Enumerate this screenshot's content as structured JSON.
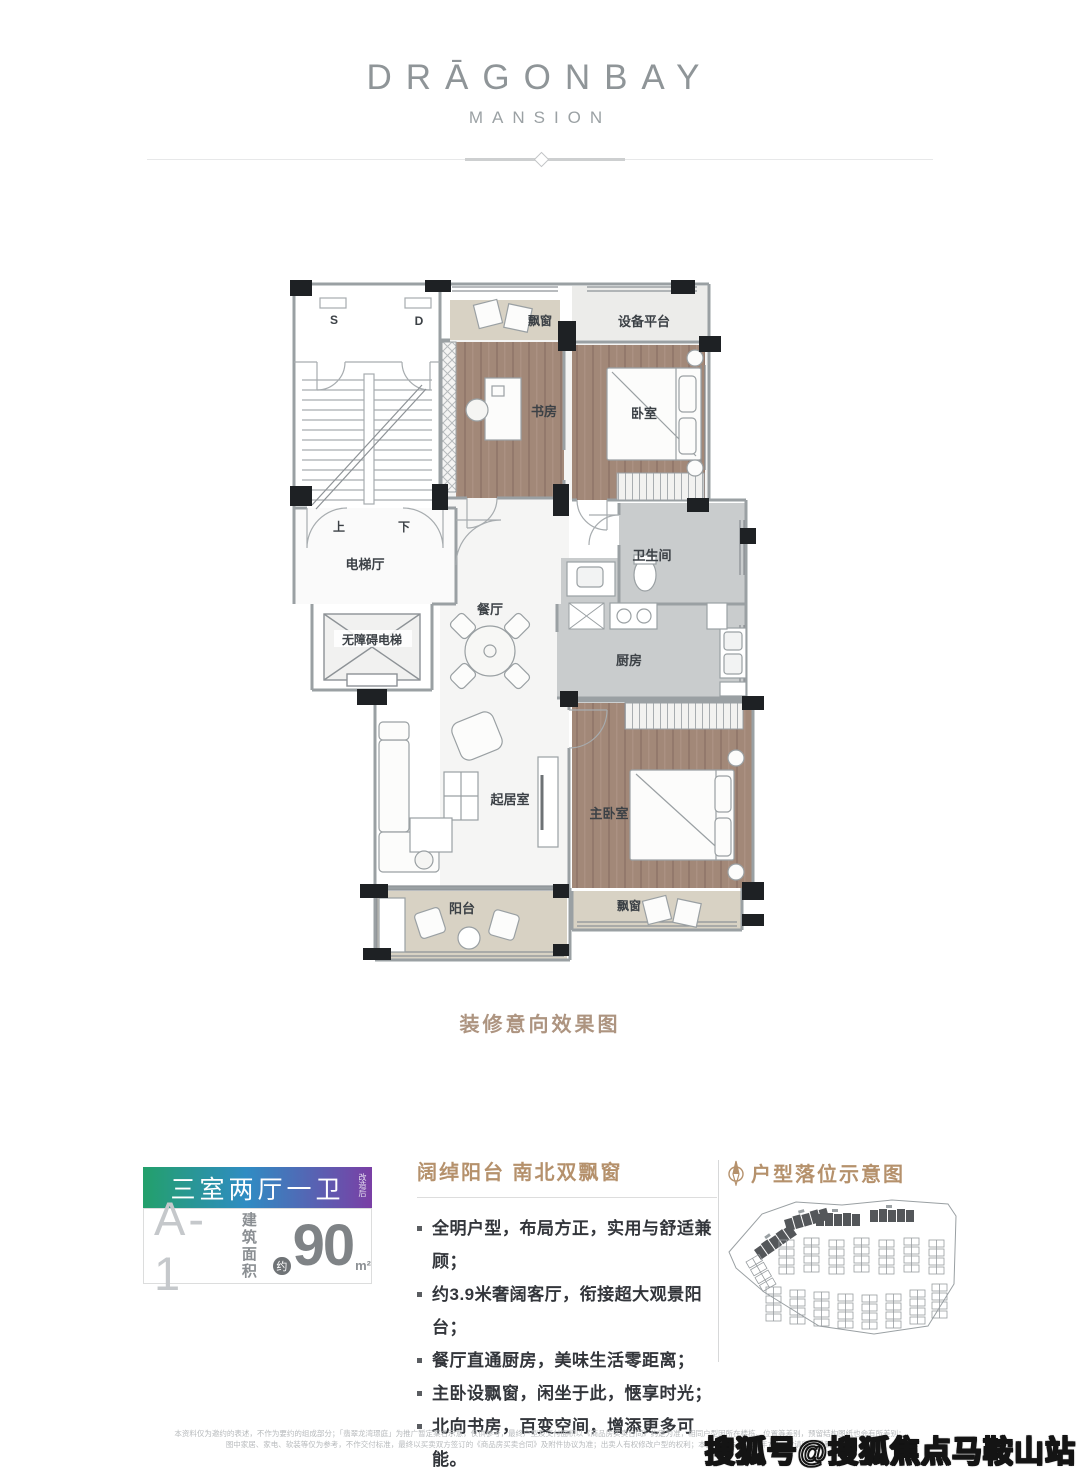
{
  "brand": {
    "name": "DRĀGONBAY",
    "subtitle": "MANSION"
  },
  "floorplan": {
    "caption": "装修意向效果图",
    "rooms": {
      "s": "S",
      "d": "D",
      "up": "上",
      "down": "下",
      "elevator_hall": "电梯厅",
      "accessible_elevator": "无障碍电梯",
      "dining": "餐厅",
      "bay_window_top": "飘窗",
      "equipment_platform": "设备平台",
      "study": "书房",
      "bedroom": "卧室",
      "bathroom": "卫生间",
      "kitchen": "厨房",
      "living": "起居室",
      "master_bedroom": "主卧室",
      "balcony": "阳台",
      "bay_window_bottom": "飘窗"
    }
  },
  "unit_card": {
    "layout": "三室两厅一卫",
    "layout_note": "改造后",
    "unit_no": "A-1",
    "area_prefix_1": "建筑",
    "area_prefix_2": "面积",
    "approx": "约",
    "area_value": "90",
    "area_unit": "m²",
    "gradient_left": "#23a06b",
    "gradient_mid": "#2f8cc3",
    "gradient_right": "#7a3fa5"
  },
  "features": {
    "heading": "阔绰阳台 南北双飘窗",
    "bullets": [
      "全明户型，布局方正，实用与舒适兼顾；",
      "约3.9米奢阔客厅，衔接超大观景阳台；",
      "餐厅直通厨房，美味生活零距离；",
      "主卧设飘窗，闲坐于此，惬享时光；",
      "北向书房，百变空间，增添更多可能。"
    ]
  },
  "siteplan": {
    "heading": "户型落位示意图"
  },
  "footer": {
    "disclaimer_line1": "本资料仅为邀约的表述，不作为要约的组成部分；「翡翠龙湾璟庭」为推广暂定案名示意，仅供参考，最终户型及交付面积以《商品房买卖合同》约定为准，相同户型因所在楼栋、位置等差别，预留结构图纸也会有所差别；",
    "disclaimer_line2": "图中家居、家电、软装等仅为参考，不作交付标准，最终以买卖双方签订的《商品房买卖合同》及附件协议为准；出卖人有权修改户型的权利；本资料发布于2020年7月，敬请留意最新资料。",
    "watermark": "搜狐号@搜狐焦点马鞍山站"
  },
  "colors": {
    "accent_tan": "#b5916c",
    "wood": "#a28878",
    "bay": "#d8d2c4",
    "wall": "#9aa0a3"
  }
}
